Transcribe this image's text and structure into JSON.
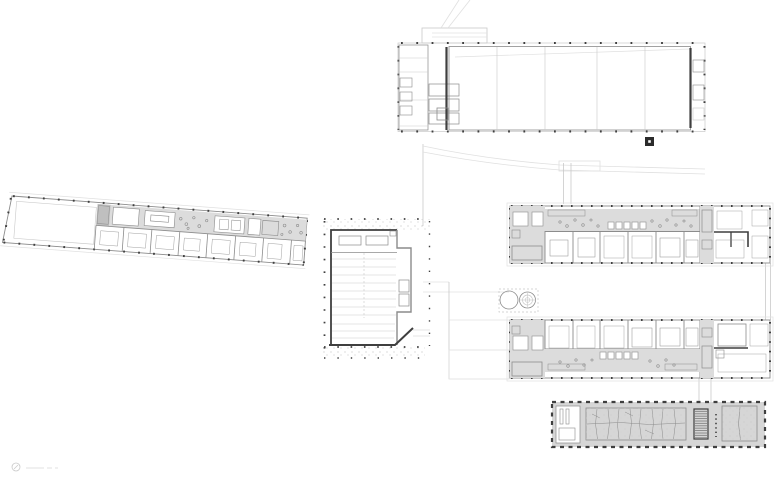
{
  "canvas": {
    "width": 780,
    "height": 483,
    "background": "#ffffff"
  },
  "colors": {
    "line_dark": "#3f3f3f",
    "line_mid": "#8c8c8c",
    "line_faint": "#c9c9c9",
    "line_xfaint": "#e0e0e0",
    "fill_gray": "#dcdcdc",
    "fill_gray_dark": "#d6d6d6",
    "fill_inner": "#e7e7e7",
    "marker_dark": "#2b2b2b"
  },
  "icons": {
    "drawing_stamp": "circle-stamp-icon",
    "column_marker": "filled-square-with-white-center"
  },
  "footer": {
    "stamp_text": ""
  }
}
